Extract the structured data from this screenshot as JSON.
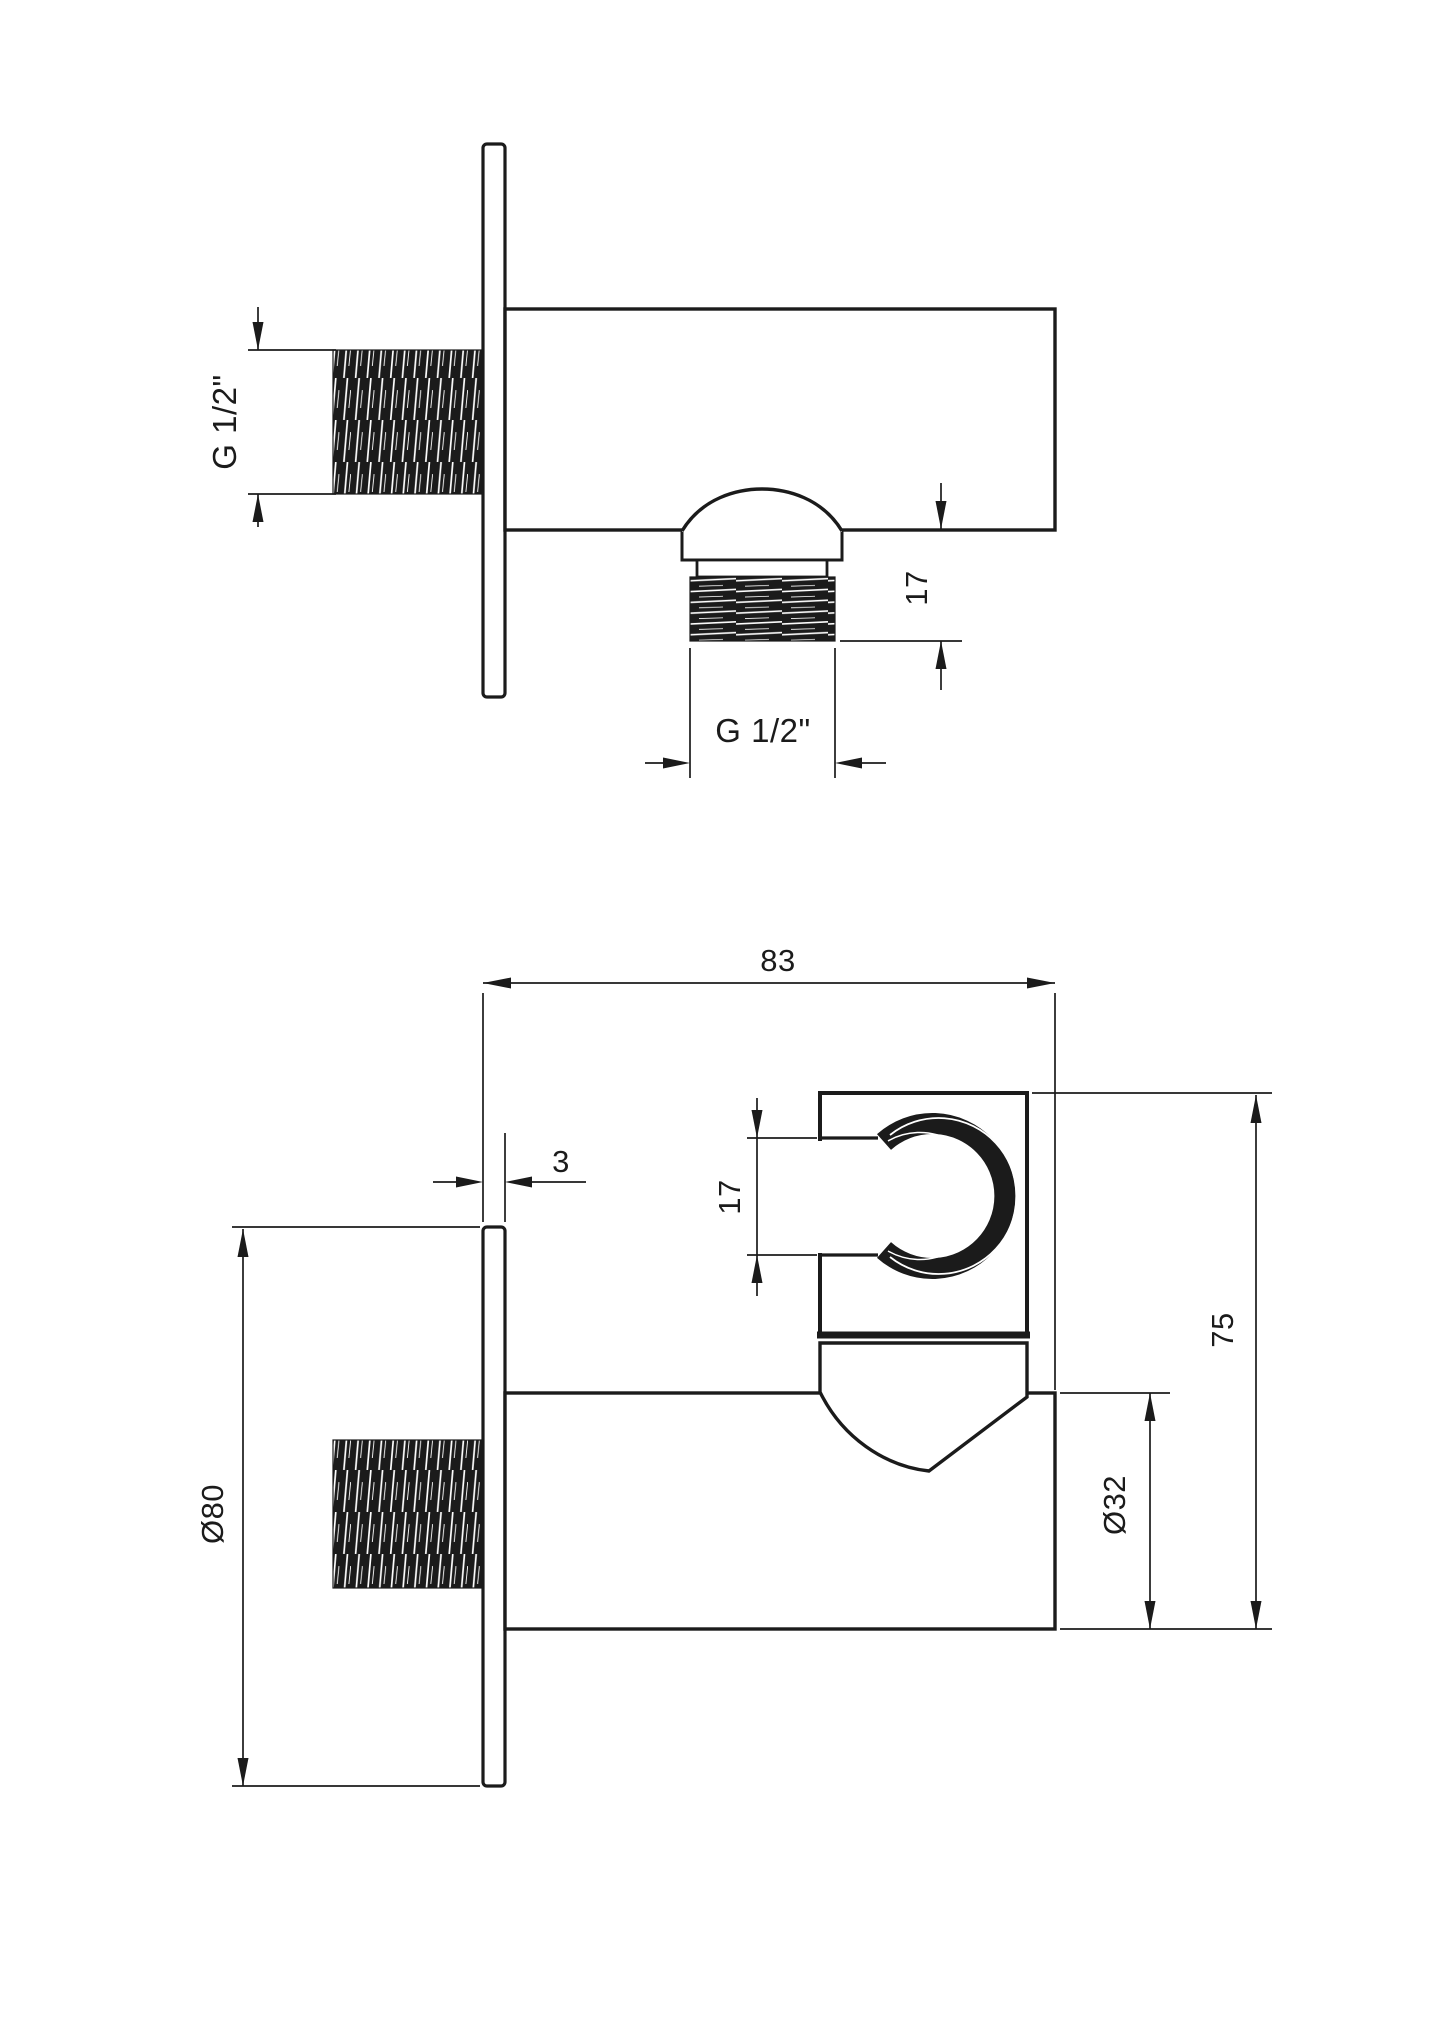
{
  "drawing": {
    "line_color": "#1b1b1b",
    "background_color": "#ffffff",
    "top_view": {
      "inlet_thread_label": "G 1/2\"",
      "outlet_length_label": "17",
      "outlet_thread_label": "G 1/2\""
    },
    "bottom_view": {
      "depth_label": "83",
      "plate_thickness_label": "3",
      "holder_opening_label": "17",
      "height_label": "75",
      "body_diameter_label": "Ø32",
      "plate_diameter_label": "Ø80"
    }
  }
}
